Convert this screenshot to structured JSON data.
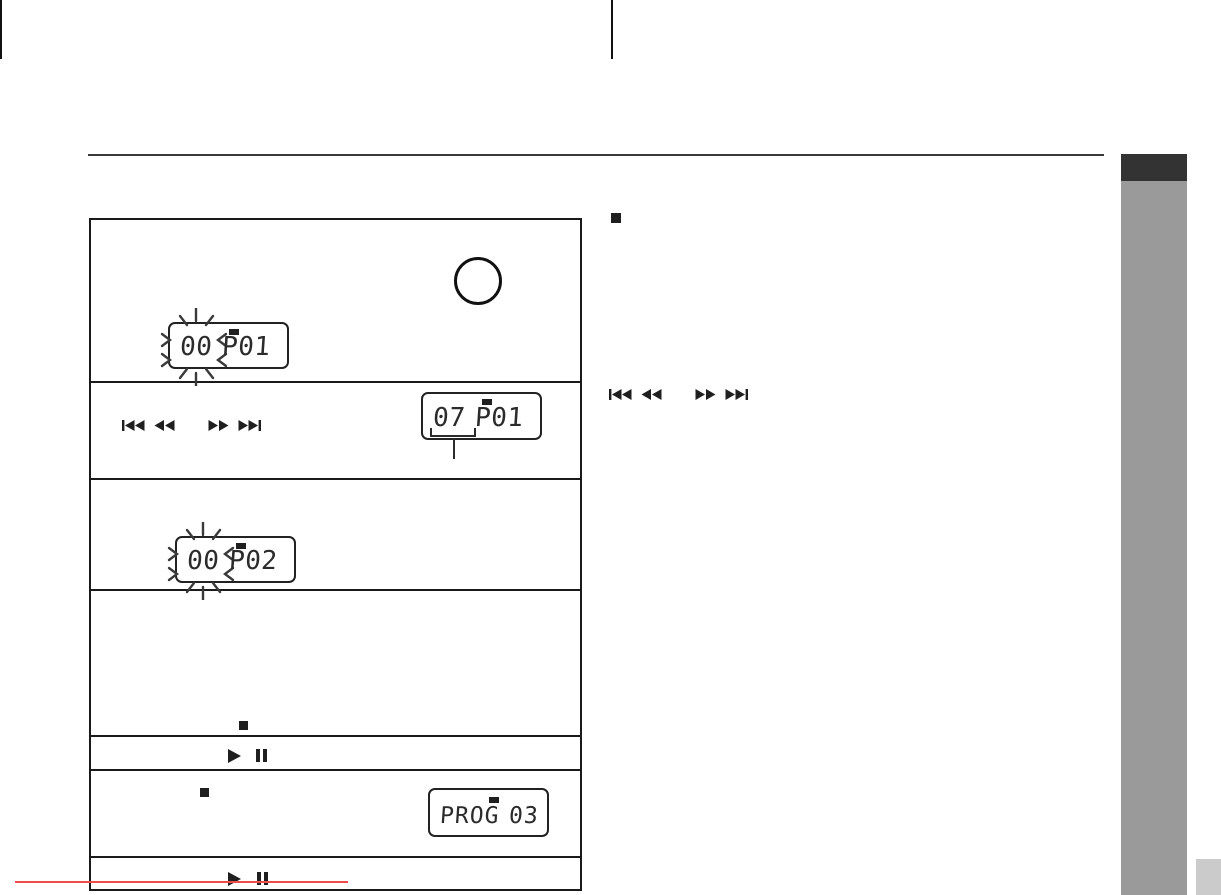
{
  "colors": {
    "tab_dark": "#333333",
    "sidebar_gray": "#9a9a9a",
    "corner_badge": "#cbcbcb",
    "table_border": "#1a1a1a",
    "red_line": "#f04b4b"
  },
  "steps_table": {
    "rows": [
      {
        "step": "press-program-button",
        "icons": [
          "circle-button"
        ],
        "lcd": {
          "track": "00",
          "program": "P01",
          "blinking": true
        }
      },
      {
        "step": "select-track",
        "icons": [
          "skip-back",
          "rewind",
          "fast-forward",
          "skip-forward"
        ],
        "lcd": {
          "track": "07",
          "program": "P01",
          "blinking": false,
          "underlined": "07"
        }
      },
      {
        "step": "confirm-track",
        "icons": [],
        "lcd": {
          "track": "00",
          "program": "P02",
          "blinking": true
        }
      },
      {
        "step": "finish-programming",
        "icons": [
          "stop"
        ]
      },
      {
        "step": "start-playback",
        "icons": [
          "play",
          "pause"
        ]
      },
      {
        "step": "check-program",
        "icons": [
          "stop"
        ],
        "lcd": {
          "left": "PROG",
          "right": "03"
        }
      },
      {
        "step": "resume-playback",
        "icons": [
          "play",
          "pause"
        ]
      }
    ]
  },
  "notes_column": {
    "bullet": "square-bullet",
    "icons": [
      "skip-back",
      "rewind",
      "fast-forward",
      "skip-forward"
    ]
  }
}
